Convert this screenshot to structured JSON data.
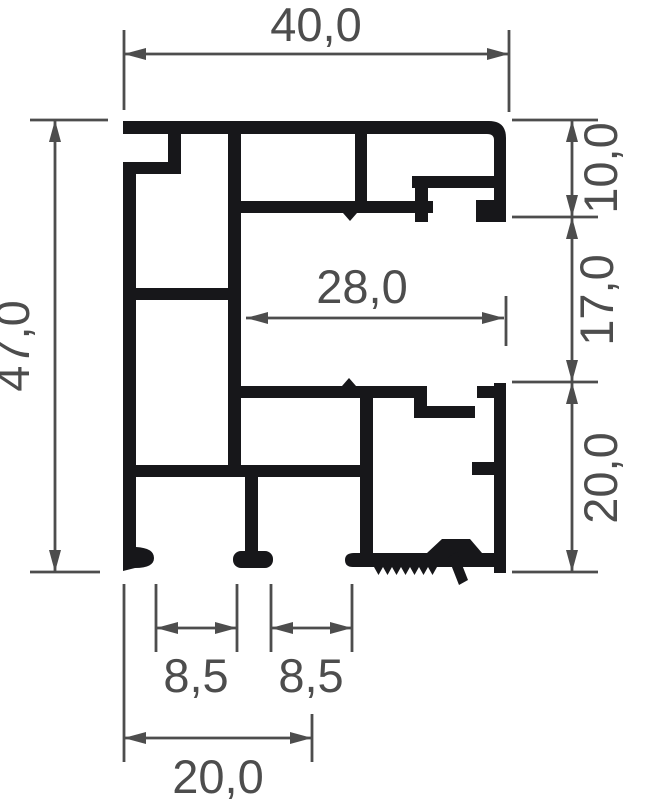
{
  "drawing": {
    "type": "profile-cross-section",
    "decimal_style": "comma"
  },
  "colors": {
    "background": "#ffffff",
    "profile": "#17171a",
    "dimension": "#4d4d4d"
  },
  "dimensions": {
    "top_width": {
      "label": "40,0",
      "value": 40.0,
      "orientation": "horizontal"
    },
    "overall_height": {
      "label": "47,0",
      "value": 47.0,
      "orientation": "vertical"
    },
    "right_upper": {
      "label": "10,0",
      "value": 10.0,
      "orientation": "vertical"
    },
    "right_middle": {
      "label": "17,0",
      "value": 17.0,
      "orientation": "vertical"
    },
    "right_lower": {
      "label": "20,0",
      "value": 20.0,
      "orientation": "vertical"
    },
    "inner_width": {
      "label": "28,0",
      "value": 28.0,
      "orientation": "horizontal"
    },
    "groove_left": {
      "label": "8,5",
      "value": 8.5,
      "orientation": "horizontal"
    },
    "groove_right": {
      "label": "8,5",
      "value": 8.5,
      "orientation": "horizontal"
    },
    "bottom_width": {
      "label": "20,0",
      "value": 20.0,
      "orientation": "horizontal"
    }
  }
}
